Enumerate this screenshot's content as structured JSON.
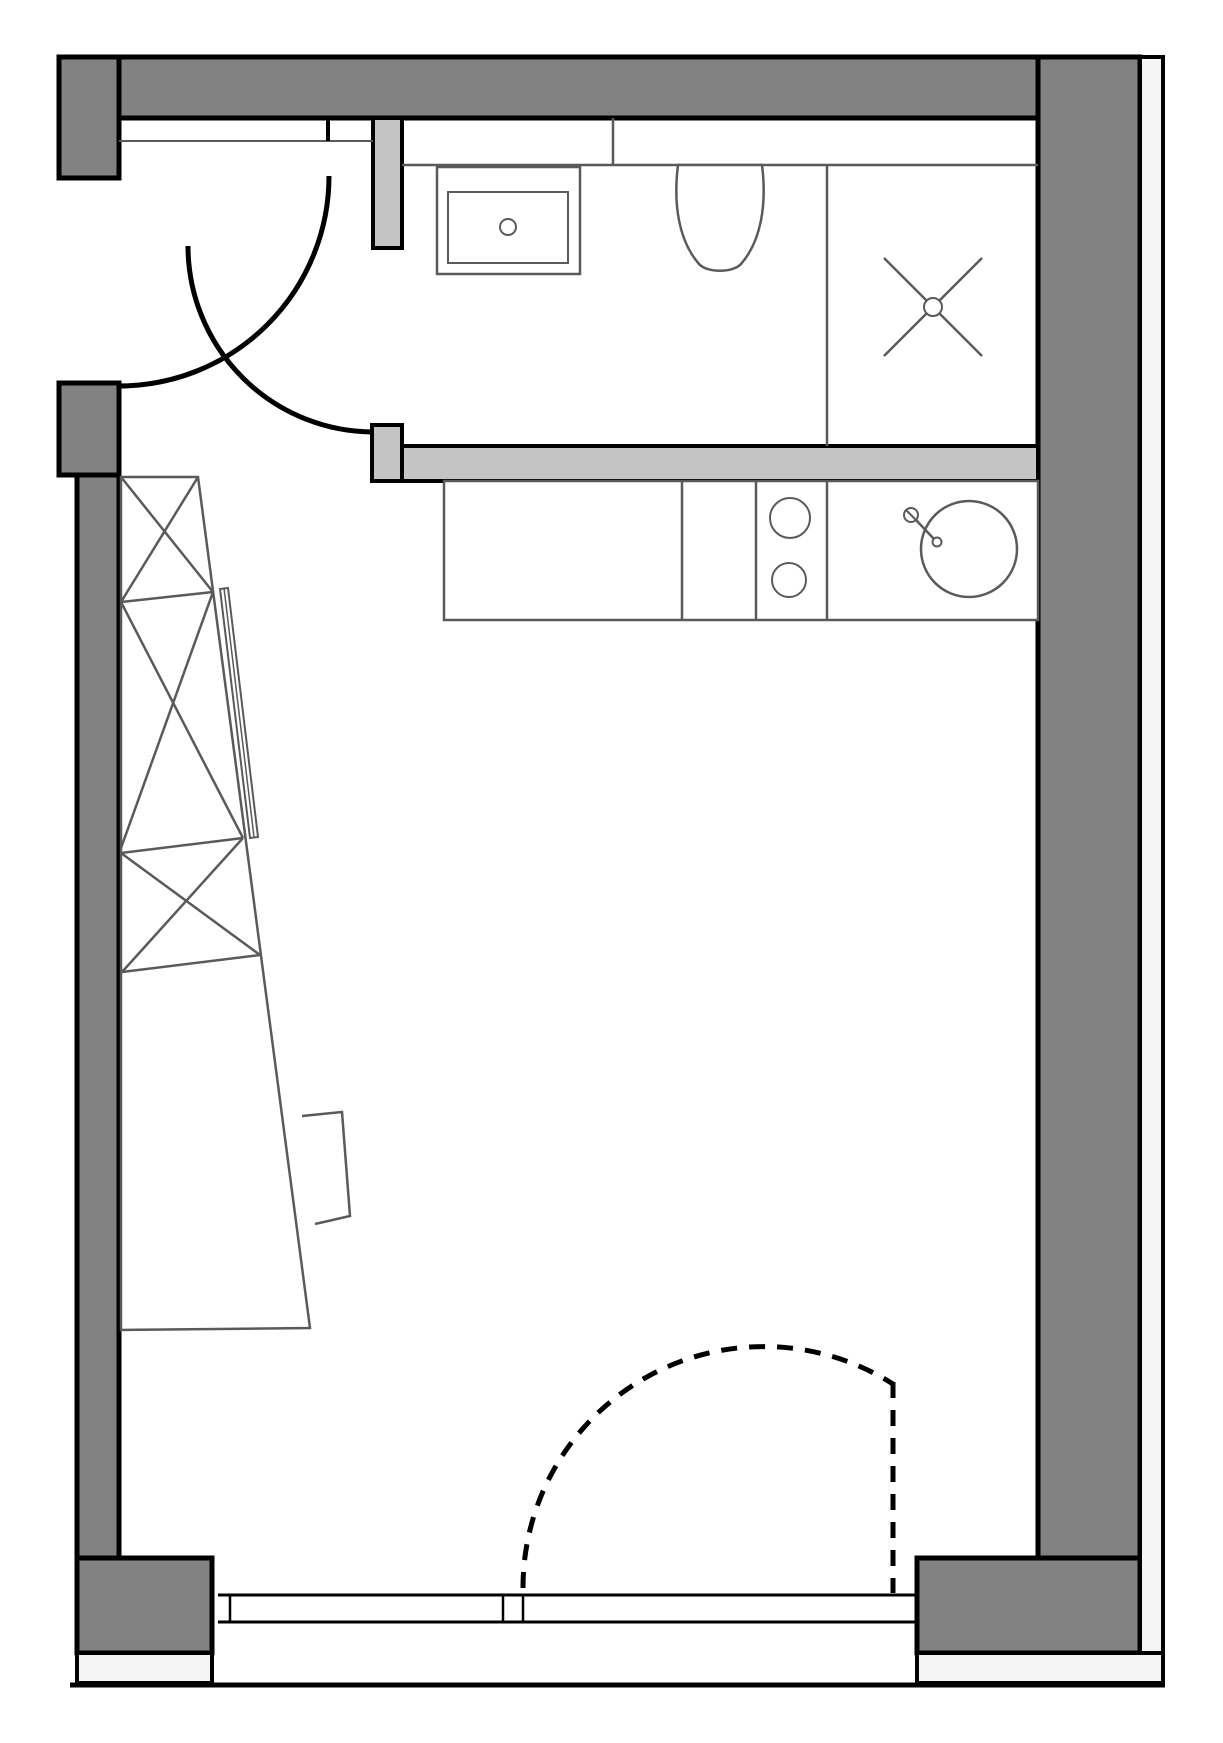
{
  "canvas": {
    "width": 1223,
    "height": 1743,
    "background": "#ffffff"
  },
  "colors": {
    "wall_dark": "#828282",
    "wall_light": "#c4c4c4",
    "exterior_strip": "#f5f5f5",
    "outline": "#000000",
    "fixture": "#5a5a5a",
    "white": "#ffffff"
  },
  "plan": {
    "walls": [
      {
        "name": "top-wall",
        "shape": "rect",
        "x": 59,
        "y": 57,
        "w": 1081,
        "h": 61,
        "fill": "wall_dark",
        "stroke": "outline",
        "sw": 5
      },
      {
        "name": "left-wall-upper",
        "shape": "rect",
        "x": 59,
        "y": 57,
        "w": 60,
        "h": 121,
        "fill": "wall_dark",
        "stroke": "outline",
        "sw": 5
      },
      {
        "name": "left-wall-mid",
        "shape": "rect",
        "x": 59,
        "y": 383,
        "w": 60,
        "h": 92,
        "fill": "wall_dark",
        "stroke": "outline",
        "sw": 5
      },
      {
        "name": "left-wall-lower",
        "shape": "rect",
        "x": 77,
        "y": 475,
        "w": 42,
        "h": 1083,
        "fill": "wall_dark",
        "stroke": "outline",
        "sw": 5
      },
      {
        "name": "bottom-left-wall-block",
        "shape": "rect",
        "x": 77,
        "y": 1558,
        "w": 135,
        "h": 95,
        "fill": "wall_dark",
        "stroke": "outline",
        "sw": 5
      },
      {
        "name": "right-wall",
        "shape": "rect",
        "x": 1038,
        "y": 57,
        "w": 102,
        "h": 1596,
        "fill": "wall_dark",
        "stroke": "outline",
        "sw": 5
      },
      {
        "name": "bottom-right-wall-block",
        "shape": "rect",
        "x": 917,
        "y": 1558,
        "w": 223,
        "h": 95,
        "fill": "wall_dark",
        "stroke": "outline",
        "sw": 5
      }
    ],
    "exterior": [
      {
        "name": "right-exterior-strip",
        "shape": "rect",
        "x": 1140,
        "y": 57,
        "w": 23,
        "h": 1626,
        "fill": "exterior_strip",
        "stroke": "outline",
        "sw": 4
      },
      {
        "name": "bottom-left-exterior-strip",
        "shape": "rect",
        "x": 77,
        "y": 1653,
        "w": 135,
        "h": 30,
        "fill": "exterior_strip",
        "stroke": "outline",
        "sw": 4
      },
      {
        "name": "bottom-right-exterior-strip",
        "shape": "rect",
        "x": 917,
        "y": 1653,
        "w": 246,
        "h": 30,
        "fill": "exterior_strip",
        "stroke": "outline",
        "sw": 4
      },
      {
        "name": "bottom-outer-edge",
        "shape": "line",
        "x1": 70,
        "y1": 1685,
        "x2": 1165,
        "y2": 1685,
        "stroke": "outline",
        "sw": 5
      }
    ],
    "partitions": [
      {
        "name": "entry-door-jamb",
        "shape": "rect",
        "x": 373,
        "y": 118,
        "w": 29,
        "h": 130,
        "fill": "wall_light",
        "stroke": "outline",
        "sw": 4
      },
      {
        "name": "bathroom-door-stub",
        "shape": "rect",
        "x": 372,
        "y": 425,
        "w": 30,
        "h": 56,
        "fill": "wall_light",
        "stroke": "outline",
        "sw": 4
      },
      {
        "name": "bathroom-partition-wall",
        "shape": "rect",
        "x": 402,
        "y": 446,
        "w": 636,
        "h": 35,
        "fill": "wall_light",
        "stroke": "outline",
        "sw": 4
      }
    ],
    "vestibule": [
      {
        "name": "vestibule-shelf-line",
        "shape": "line",
        "x1": 119,
        "y1": 141,
        "x2": 373,
        "y2": 141,
        "stroke": "fixture",
        "sw": 2
      },
      {
        "name": "vestibule-partition-tick",
        "shape": "line",
        "x1": 328,
        "y1": 118,
        "x2": 328,
        "y2": 141,
        "stroke": "outline",
        "sw": 4
      }
    ],
    "bathroom": [
      {
        "name": "cistern-band-bottom-line",
        "shape": "line",
        "x1": 402,
        "y1": 165,
        "x2": 1038,
        "y2": 165,
        "stroke": "fixture",
        "sw": 2.5
      },
      {
        "name": "cistern-band-divider",
        "shape": "line",
        "x1": 613,
        "y1": 118,
        "x2": 613,
        "y2": 165,
        "stroke": "fixture",
        "sw": 2.5
      },
      {
        "name": "toilet-shower-divider",
        "shape": "line",
        "x1": 827,
        "y1": 165,
        "x2": 827,
        "y2": 446,
        "stroke": "fixture",
        "sw": 2.5
      },
      {
        "name": "vanity-counter",
        "shape": "rect",
        "x": 437,
        "y": 167,
        "w": 143,
        "h": 107,
        "fill": "white",
        "stroke": "fixture",
        "sw": 2.5
      },
      {
        "name": "vanity-basin",
        "shape": "rect",
        "x": 448,
        "y": 192,
        "w": 120,
        "h": 71,
        "fill": "none",
        "stroke": "fixture",
        "sw": 2
      },
      {
        "name": "vanity-drain",
        "shape": "circle",
        "cx": 508,
        "cy": 227,
        "r": 8,
        "fill": "white",
        "stroke": "fixture",
        "sw": 2
      },
      {
        "name": "toilet-bowl",
        "shape": "path",
        "d": "M 678 165 C 673 205 679 241 699 264 C 707 273 733 273 741 264 C 761 241 767 205 762 165 Z",
        "fill": "white",
        "stroke": "fixture",
        "sw": 2.5
      },
      {
        "name": "shower-drain-cross-1",
        "shape": "line",
        "x1": 884,
        "y1": 258,
        "x2": 982,
        "y2": 356,
        "stroke": "fixture",
        "sw": 2.5
      },
      {
        "name": "shower-drain-cross-2",
        "shape": "line",
        "x1": 982,
        "y1": 258,
        "x2": 884,
        "y2": 356,
        "stroke": "fixture",
        "sw": 2.5
      },
      {
        "name": "shower-drain-circle",
        "shape": "circle",
        "cx": 933,
        "cy": 307,
        "r": 9,
        "fill": "white",
        "stroke": "fixture",
        "sw": 2
      }
    ],
    "kitchen": [
      {
        "name": "kitchen-counter",
        "shape": "rect",
        "x": 444,
        "y": 481,
        "w": 594,
        "h": 139,
        "fill": "white",
        "stroke": "fixture",
        "sw": 2.5
      },
      {
        "name": "counter-divider-1",
        "shape": "line",
        "x1": 682,
        "y1": 481,
        "x2": 682,
        "y2": 620,
        "stroke": "fixture",
        "sw": 2.5
      },
      {
        "name": "counter-divider-2",
        "shape": "line",
        "x1": 756,
        "y1": 481,
        "x2": 756,
        "y2": 620,
        "stroke": "fixture",
        "sw": 2.5
      },
      {
        "name": "counter-divider-3",
        "shape": "line",
        "x1": 827,
        "y1": 481,
        "x2": 827,
        "y2": 620,
        "stroke": "fixture",
        "sw": 2.5
      },
      {
        "name": "hob-burner-1",
        "shape": "circle",
        "cx": 790,
        "cy": 518,
        "r": 20,
        "fill": "white",
        "stroke": "fixture",
        "sw": 2
      },
      {
        "name": "hob-burner-2",
        "shape": "circle",
        "cx": 789,
        "cy": 580,
        "r": 17,
        "fill": "white",
        "stroke": "fixture",
        "sw": 2
      },
      {
        "name": "kitchen-sink-bowl",
        "shape": "circle",
        "cx": 969,
        "cy": 549,
        "r": 48,
        "fill": "white",
        "stroke": "fixture",
        "sw": 2.5
      },
      {
        "name": "faucet-handle",
        "shape": "circle",
        "cx": 911,
        "cy": 515,
        "r": 7,
        "fill": "white",
        "stroke": "fixture",
        "sw": 2
      },
      {
        "name": "faucet-handle-slash",
        "shape": "line",
        "x1": 906,
        "y1": 510,
        "x2": 916,
        "y2": 520,
        "stroke": "fixture",
        "sw": 2
      },
      {
        "name": "faucet-stem",
        "shape": "line",
        "x1": 916,
        "y1": 520,
        "x2": 934,
        "y2": 539,
        "stroke": "fixture",
        "sw": 2.5
      },
      {
        "name": "faucet-spout",
        "shape": "circle",
        "cx": 937,
        "cy": 542,
        "r": 4.5,
        "fill": "white",
        "stroke": "fixture",
        "sw": 2
      }
    ],
    "wardrobe": [
      {
        "name": "wardrobe-outline",
        "shape": "polygon",
        "points": "121,477 198,477 310,1328 121,1330",
        "fill": "white",
        "stroke": "fixture",
        "sw": 2.5
      },
      {
        "name": "wardrobe-shelf-1",
        "shape": "line",
        "x1": 121,
        "y1": 602,
        "x2": 213,
        "y2": 592,
        "stroke": "fixture",
        "sw": 2.5
      },
      {
        "name": "wardrobe-shelf-2",
        "shape": "line",
        "x1": 121,
        "y1": 853,
        "x2": 243,
        "y2": 838,
        "stroke": "fixture",
        "sw": 2.5
      },
      {
        "name": "wardrobe-shelf-3",
        "shape": "line",
        "x1": 122,
        "y1": 972,
        "x2": 260,
        "y2": 955,
        "stroke": "fixture",
        "sw": 2.5
      },
      {
        "name": "wardrobe-x1-a",
        "shape": "line",
        "x1": 121,
        "y1": 477,
        "x2": 213,
        "y2": 592,
        "stroke": "fixture",
        "sw": 2.5
      },
      {
        "name": "wardrobe-x1-b",
        "shape": "line",
        "x1": 198,
        "y1": 477,
        "x2": 121,
        "y2": 602,
        "stroke": "fixture",
        "sw": 2.5
      },
      {
        "name": "wardrobe-x2-a",
        "shape": "line",
        "x1": 121,
        "y1": 602,
        "x2": 243,
        "y2": 838,
        "stroke": "fixture",
        "sw": 2.5
      },
      {
        "name": "wardrobe-x2-b",
        "shape": "line",
        "x1": 213,
        "y1": 592,
        "x2": 121,
        "y2": 848,
        "stroke": "fixture",
        "sw": 2.5
      },
      {
        "name": "wardrobe-x3-a",
        "shape": "line",
        "x1": 121,
        "y1": 853,
        "x2": 260,
        "y2": 955,
        "stroke": "fixture",
        "sw": 2.5
      },
      {
        "name": "wardrobe-x3-b",
        "shape": "line",
        "x1": 243,
        "y1": 838,
        "x2": 122,
        "y2": 972,
        "stroke": "fixture",
        "sw": 2.5
      },
      {
        "name": "wardrobe-sliding-panel",
        "shape": "polygon",
        "points": "220,589 228,588 258,837 250,838",
        "fill": "white",
        "stroke": "fixture",
        "sw": 2
      },
      {
        "name": "wardrobe-sliding-panel-midline",
        "shape": "line",
        "x1": 224,
        "y1": 588,
        "x2": 254,
        "y2": 837,
        "stroke": "fixture",
        "sw": 1.5
      },
      {
        "name": "side-chair",
        "shape": "polyline",
        "points": "302,1116 342,1112 350,1216 315,1224",
        "fill": "none",
        "stroke": "fixture",
        "sw": 2.5
      }
    ],
    "doors": [
      {
        "name": "entry-door-swing-arc",
        "shape": "path",
        "d": "M 329 176 A 210 210 0 0 1 119 386",
        "fill": "none",
        "stroke": "outline",
        "sw": 5
      },
      {
        "name": "bathroom-door-swing-arc",
        "shape": "path",
        "d": "M 188 246 A 186 186 0 0 0 374 432",
        "fill": "none",
        "stroke": "outline",
        "sw": 5
      },
      {
        "name": "balcony-door-swing-arc",
        "shape": "path",
        "d": "M 523 1588 A 241 241 0 0 1 893 1384",
        "fill": "none",
        "stroke": "outline",
        "sw": 5,
        "dash": "16 12"
      },
      {
        "name": "balcony-door-leaf",
        "shape": "line",
        "x1": 893,
        "y1": 1382,
        "x2": 893,
        "y2": 1593,
        "stroke": "outline",
        "sw": 5,
        "dash": "16 12"
      }
    ],
    "window": [
      {
        "name": "window-inner-line",
        "shape": "line",
        "x1": 218,
        "y1": 1595,
        "x2": 917,
        "y2": 1595,
        "stroke": "outline",
        "sw": 3
      },
      {
        "name": "window-outer-line",
        "shape": "line",
        "x1": 218,
        "y1": 1622,
        "x2": 917,
        "y2": 1622,
        "stroke": "outline",
        "sw": 3
      },
      {
        "name": "window-mullion-1",
        "shape": "line",
        "x1": 230,
        "y1": 1595,
        "x2": 230,
        "y2": 1622,
        "stroke": "outline",
        "sw": 2.5
      },
      {
        "name": "window-mullion-2",
        "shape": "line",
        "x1": 503,
        "y1": 1595,
        "x2": 503,
        "y2": 1622,
        "stroke": "outline",
        "sw": 2.5
      },
      {
        "name": "window-mullion-3",
        "shape": "line",
        "x1": 523,
        "y1": 1595,
        "x2": 523,
        "y2": 1622,
        "stroke": "outline",
        "sw": 2.5
      }
    ]
  },
  "group_order": [
    "walls",
    "exterior",
    "partitions",
    "vestibule",
    "bathroom",
    "kitchen",
    "wardrobe",
    "doors",
    "window"
  ]
}
